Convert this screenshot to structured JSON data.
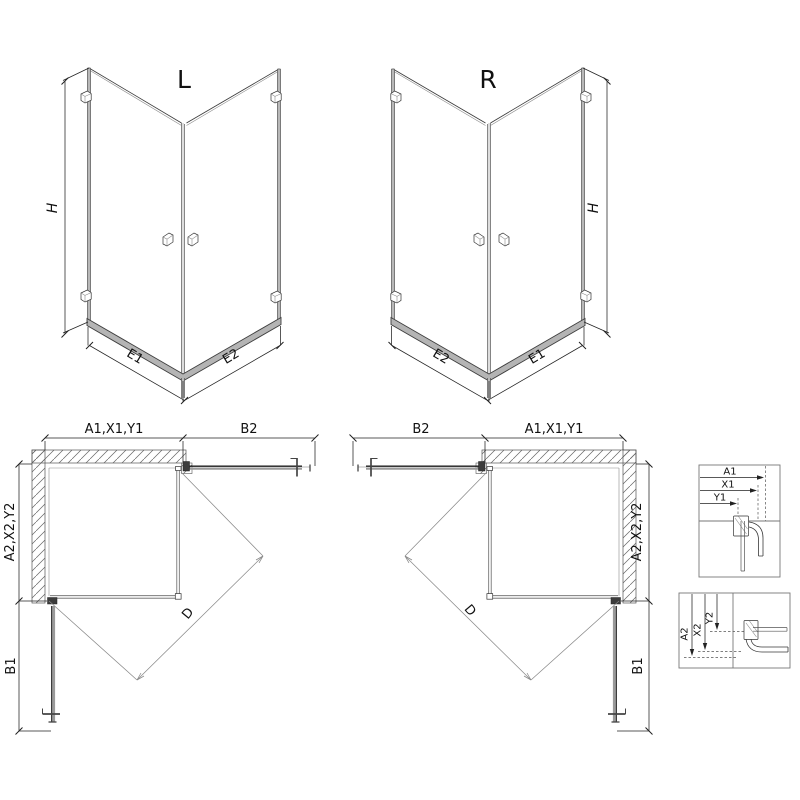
{
  "views": {
    "iso_left": {
      "label": "L",
      "h": "H",
      "e_left": "E1",
      "e_right": "E2"
    },
    "iso_right": {
      "label": "R",
      "h": "H",
      "e_left": "E2",
      "e_right": "E1"
    },
    "plan_left": {
      "top_left": "A1,X1,Y1",
      "top_right": "B2",
      "left_side": "A2,X2,Y2",
      "left_lower": "B1",
      "diagonal": "D"
    },
    "plan_right": {
      "top_left": "B2",
      "top_right": "A1,X1,Y1",
      "right_side": "A2,X2,Y2",
      "right_lower": "B1",
      "diagonal": "D"
    },
    "detail_top": {
      "a1": "A1",
      "x1": "X1",
      "y1": "Y1"
    },
    "detail_bottom": {
      "a2": "A2",
      "x2": "X2",
      "y2": "Y2"
    }
  },
  "colors": {
    "line": "#3a3a3a",
    "dimension": "#222222",
    "profile_gray": "#b4b4b4",
    "door_dark": "#1a1a1a",
    "hatch": "#666666",
    "detail_border": "#777777",
    "background": "#ffffff"
  }
}
